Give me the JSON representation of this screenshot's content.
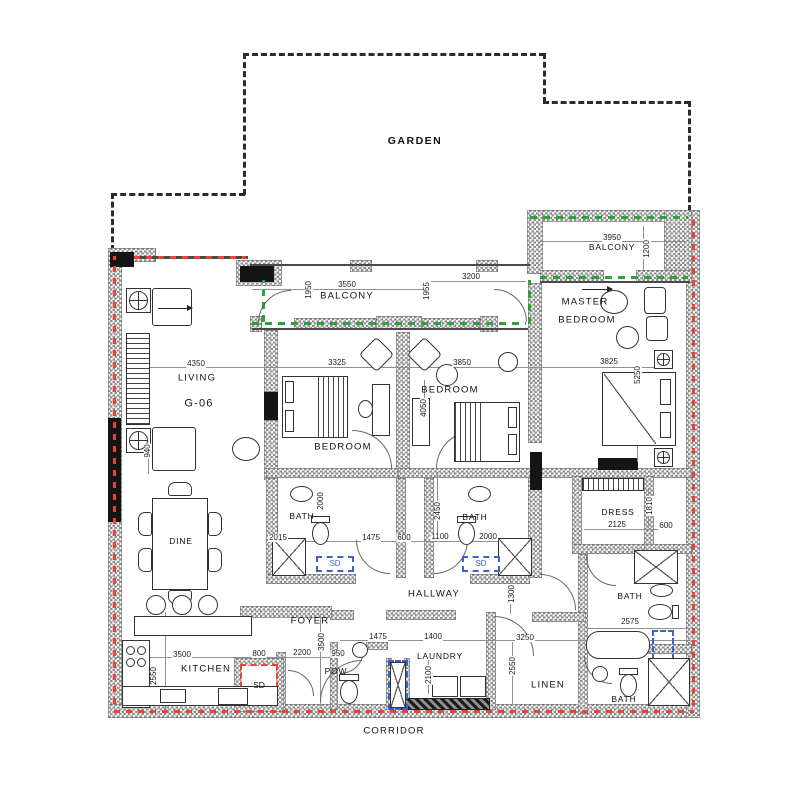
{
  "labels": {
    "garden": "GARDEN",
    "balcony_top": "BALCONY",
    "balcony_main": "BALCONY",
    "master_line1": "MASTER",
    "master_line2": "BEDROOM",
    "living": "LIVING",
    "unit": "G-06",
    "bedroom1": "BEDROOM",
    "bedroom2": "BEDROOM",
    "bath1": "BATH",
    "bath2": "BATH",
    "bath_master": "BATH",
    "bath_guest": "BATH",
    "dress": "DRESS",
    "hallway": "HALLWAY",
    "foyer": "FOYER",
    "dine": "DINE",
    "kitchen": "KITCHEN",
    "pow": "POW",
    "laundry": "LAUNDRY",
    "linen": "LINEN",
    "corridor": "CORRIDOR",
    "sd_kitchen": "SD",
    "sd_bath1": "SD",
    "sd_bath2": "SD"
  },
  "dims": {
    "balcony_top_w": "3950",
    "balcony_top_d": "1200",
    "balcony_main_w": "3550",
    "balcony_main_dl": "1950",
    "balcony_main_dr": "1955",
    "balcony_sec_w": "3200",
    "living_w": "4350",
    "living_s": "940",
    "bedroom1_w": "3325",
    "bedroom2_w": "3850",
    "bedroom2_d": "4050",
    "master_w": "3825",
    "master_d": "5250",
    "bath1_d": "2000",
    "bath1_w": "2015",
    "hall_seg1": "1475",
    "hall_seg2": "600",
    "hall_seg3": "1100",
    "bath2_w": "2000",
    "corridor_d": "2450",
    "dress_w": "2125",
    "dress_d": "1810",
    "dress_s": "600",
    "hallway_d": "1300",
    "mbath_w": "2575",
    "foyer_d": "3500",
    "foyer_w": "2200",
    "kitchen_s": "800",
    "kitchen_w": "3500",
    "kitchen_d": "2550",
    "pow_w": "950",
    "pow_s": "1475",
    "laundry_w": "1400",
    "laundry_d": "2100",
    "linen_w": "3250",
    "linen_d": "2550"
  }
}
